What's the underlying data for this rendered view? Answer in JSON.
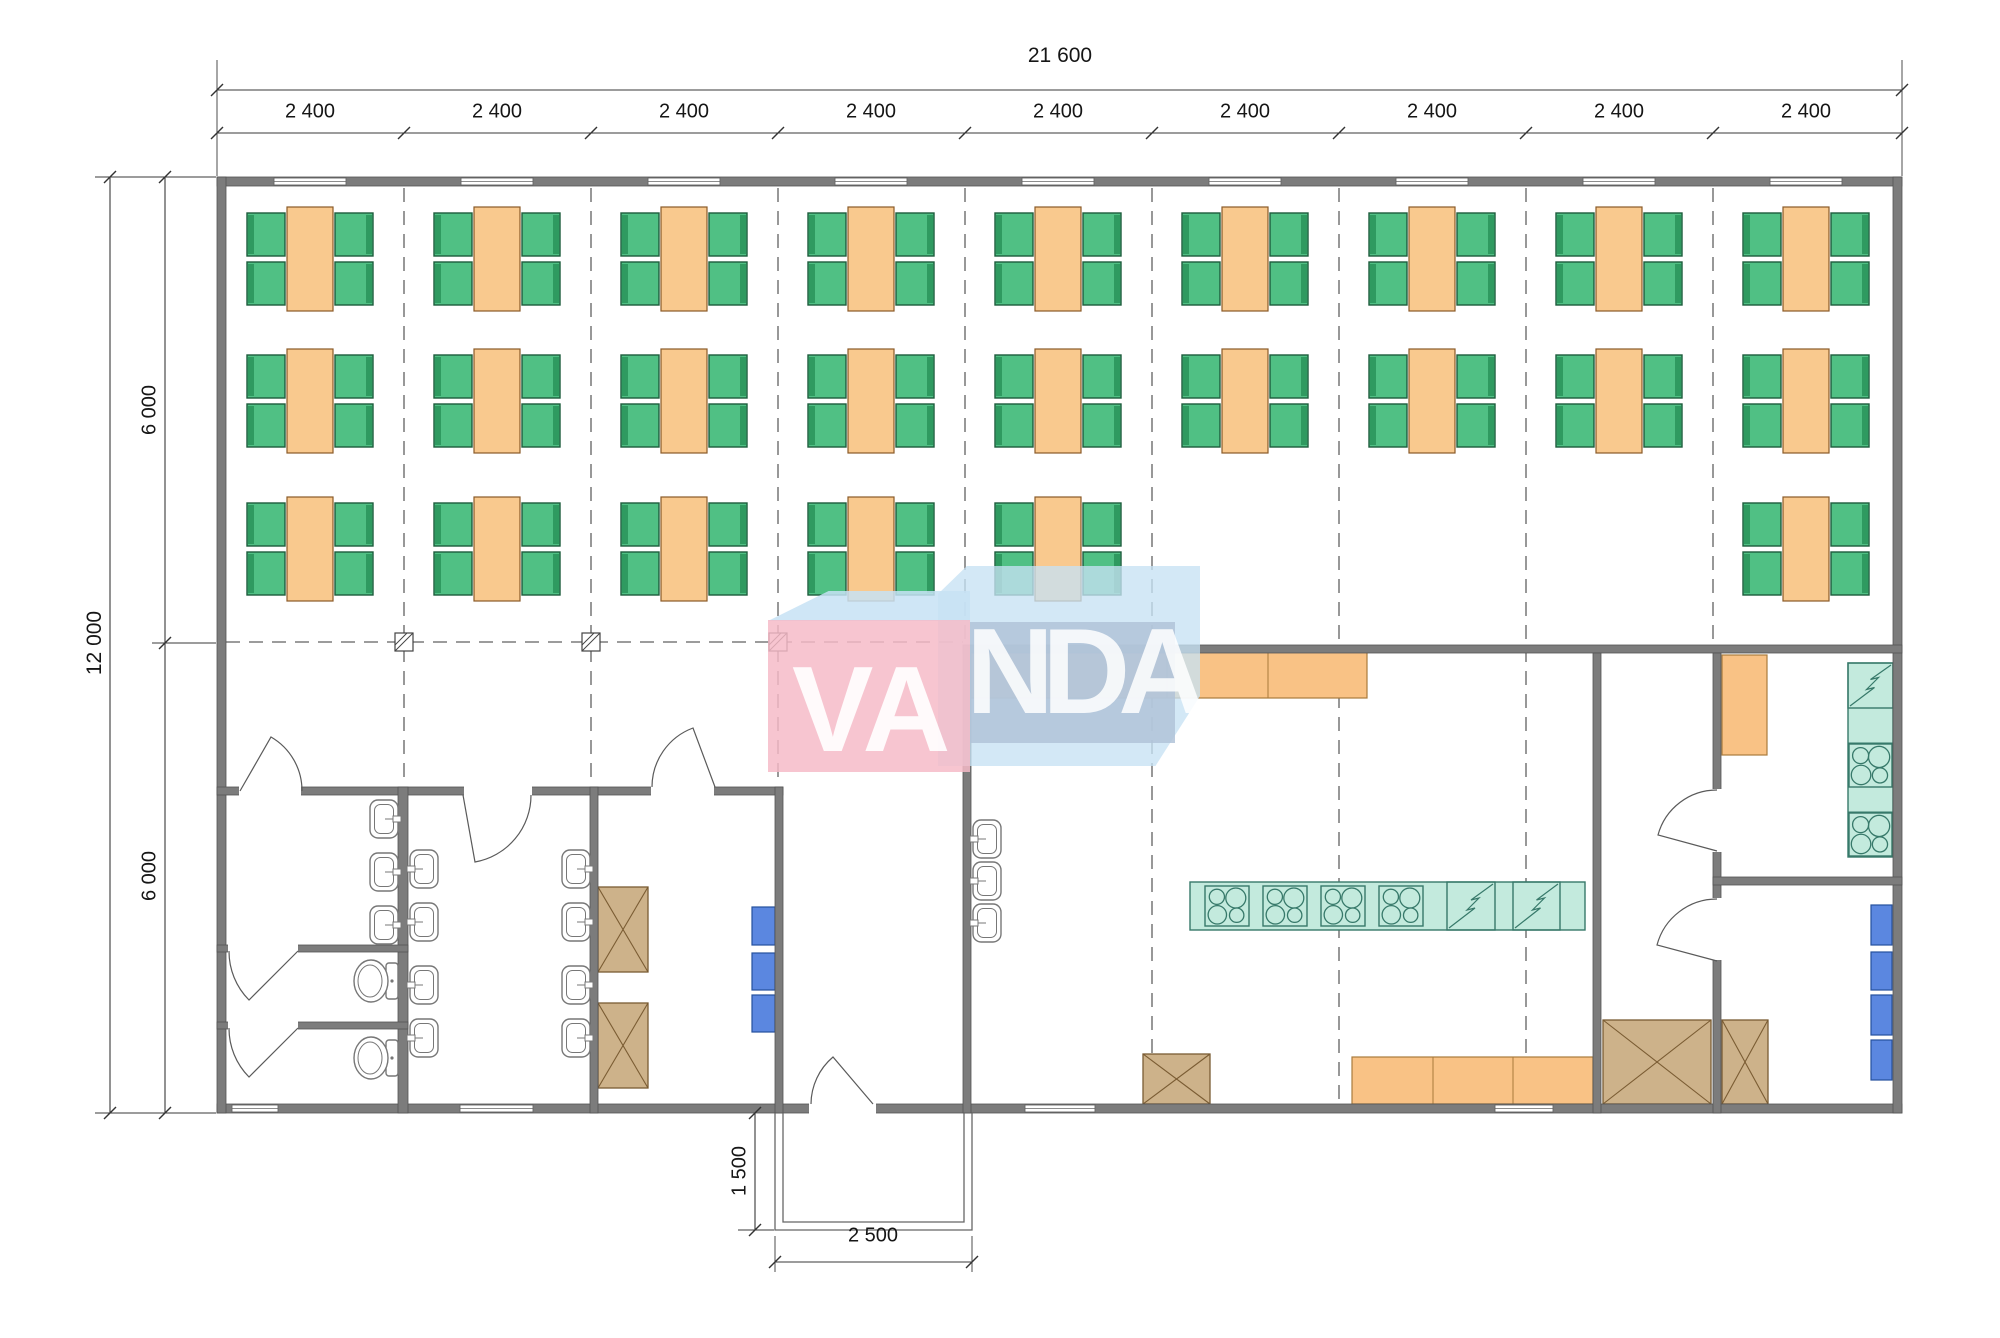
{
  "watermark": {
    "left": "VA",
    "right": "NDA"
  },
  "dimensions": {
    "total_width": "21 600",
    "module_widths": [
      "2 400",
      "2 400",
      "2 400",
      "2 400",
      "2 400",
      "2 400",
      "2 400",
      "2 400",
      "2 400"
    ],
    "total_depth": "12 000",
    "depth_halves": [
      "6 000",
      "6 000"
    ],
    "entrance_porch_depth": "1 500",
    "entrance_porch_width": "2 500"
  },
  "colors": {
    "wall": "#7c7c7c",
    "wallEdge": "#545454",
    "table": "#f9c98e",
    "tableEdge": "#8a5a28",
    "chair": "#50c084",
    "chairDark": "#2f9a60",
    "chairEdge": "#1d5c3c",
    "counter": "#f9c285",
    "counterEdge": "#a97b3c",
    "teal": "#c3eadd",
    "tealEdge": "#37796a",
    "blue": "#5b87e0",
    "blueEdge": "#24509e",
    "cabinet": "#cdb28a",
    "cabinetEdge": "#7a5c33",
    "fixture": "#777777",
    "line": "#5a5a5a",
    "grid": "#606060",
    "dim": "#3a3a3a"
  },
  "plan": {
    "moduleCenters": [
      310,
      497,
      684,
      871,
      1058,
      1245,
      1432,
      1619,
      1806
    ],
    "tables": {
      "rows": [
        259,
        401,
        549
      ],
      "layout": [
        [
          1,
          1,
          1,
          1,
          1,
          1,
          1,
          1,
          1
        ],
        [
          1,
          1,
          1,
          1,
          1,
          1,
          1,
          1,
          1
        ],
        [
          1,
          1,
          1,
          1,
          1,
          0,
          0,
          0,
          1
        ]
      ]
    },
    "gridV": [
      [
        404,
        188,
        785
      ],
      [
        591,
        188,
        785
      ],
      [
        778,
        188,
        785
      ],
      [
        965,
        188,
        643
      ],
      [
        1152,
        188,
        1102
      ],
      [
        1339,
        188,
        1102
      ],
      [
        1526,
        188,
        1102
      ],
      [
        1713,
        188,
        650
      ]
    ],
    "gridH": [
      [
        226,
        642,
        963
      ]
    ],
    "markers": [
      [
        404,
        642
      ],
      [
        591,
        642
      ],
      [
        778,
        642
      ]
    ],
    "walls": [
      [
        217,
        177,
        1685,
        9
      ],
      [
        217,
        1104,
        1685,
        9
      ],
      [
        217,
        177,
        9,
        936
      ],
      [
        1893,
        177,
        9,
        936
      ],
      [
        217,
        787,
        566,
        8
      ],
      [
        398,
        787,
        10,
        326
      ],
      [
        217,
        945,
        191,
        7
      ],
      [
        217,
        1022,
        191,
        7
      ],
      [
        590,
        787,
        8,
        326
      ],
      [
        775,
        787,
        8,
        326
      ],
      [
        963,
        645,
        939,
        8
      ],
      [
        963,
        645,
        8,
        468
      ],
      [
        1593,
        653,
        8,
        460
      ],
      [
        1713,
        653,
        8,
        460
      ],
      [
        1713,
        877,
        189,
        8
      ]
    ],
    "windowsTop": {
      "y": 178,
      "w": 72,
      "h": 7
    },
    "windowsBottom": [
      [
        232,
        1105,
        46,
        7
      ],
      [
        460,
        1105,
        73,
        7
      ],
      [
        1025,
        1105,
        70,
        7
      ],
      [
        1495,
        1105,
        58,
        7
      ]
    ],
    "doorOpenings": [
      [
        239,
        785,
        62,
        11
      ],
      [
        464,
        785,
        68,
        11
      ],
      [
        651,
        785,
        63,
        11
      ],
      [
        809,
        1102,
        67,
        12
      ],
      [
        228,
        943,
        70,
        10
      ],
      [
        228,
        1020,
        70,
        10
      ],
      [
        1711,
        789,
        11,
        63
      ],
      [
        1711,
        898,
        11,
        62
      ]
    ],
    "doorArcs": [
      "M240,791 L271,737 A62,62 0 0 1 302,791",
      "M463,795 L475,862 A68,68 0 0 0 531,795",
      "M715,787 L693,728 A63,63 0 0 0 652,787",
      "M873,1104 L833,1057 A62,62 0 0 0 811,1104",
      "M298,951 L249,1000 A69,69 0 0 1 229,951",
      "M298,1028 L249,1077 A69,69 0 0 1 229,1028",
      "M1717,851 L1658,835 A61,61 0 0 1 1717,790",
      "M1717,961 L1657,945 A62,62 0 0 1 1717,899"
    ],
    "counters": [
      {
        "x": 971,
        "y": 652,
        "w": 396,
        "h": 46,
        "div": [
          1068,
          1167,
          1268
        ]
      },
      {
        "x": 1352,
        "y": 1057,
        "w": 241,
        "h": 47,
        "div": [
          1433,
          1513
        ]
      },
      {
        "x": 1722,
        "y": 655,
        "w": 45,
        "h": 100,
        "div": []
      }
    ],
    "island": {
      "x": 1190,
      "y": 882,
      "w": 395,
      "h": 48,
      "stoves": [
        [
          1205,
          886,
          44,
          40
        ],
        [
          1263,
          886,
          44,
          40
        ],
        [
          1321,
          886,
          44,
          40
        ],
        [
          1379,
          886,
          44,
          40
        ]
      ],
      "diag": [
        [
          1447,
          882,
          48,
          48
        ],
        [
          1513,
          882,
          47,
          48
        ]
      ]
    },
    "wallColumn": {
      "x": 1848,
      "y": 663,
      "w": 45,
      "h": 194,
      "div": [
        708,
        743,
        787,
        812
      ],
      "zig": [
        1848,
        663,
        45,
        45
      ],
      "stoves": [
        [
          1849,
          744,
          43,
          43
        ],
        [
          1849,
          813,
          43,
          43
        ]
      ]
    },
    "cabinets": [
      [
        598,
        887,
        50,
        85
      ],
      [
        598,
        1003,
        50,
        85
      ],
      [
        1143,
        1054,
        67,
        50
      ],
      [
        1603,
        1020,
        108,
        84
      ],
      [
        1722,
        1020,
        46,
        84
      ]
    ],
    "blueUnits": [
      [
        752,
        907,
        23,
        38
      ],
      [
        752,
        953,
        23,
        37
      ],
      [
        752,
        995,
        23,
        37
      ],
      [
        1871,
        905,
        21,
        40
      ],
      [
        1871,
        952,
        21,
        38
      ],
      [
        1871,
        995,
        21,
        40
      ],
      [
        1871,
        1040,
        21,
        40
      ]
    ],
    "sinks": [
      {
        "x": 370,
        "y": 800,
        "tap": "right"
      },
      {
        "x": 370,
        "y": 853,
        "tap": "right"
      },
      {
        "x": 370,
        "y": 906,
        "tap": "right"
      },
      {
        "x": 410,
        "y": 850,
        "tap": "left"
      },
      {
        "x": 410,
        "y": 903,
        "tap": "left"
      },
      {
        "x": 410,
        "y": 966,
        "tap": "left"
      },
      {
        "x": 410,
        "y": 1019,
        "tap": "left"
      },
      {
        "x": 562,
        "y": 850,
        "tap": "right"
      },
      {
        "x": 562,
        "y": 903,
        "tap": "right"
      },
      {
        "x": 562,
        "y": 966,
        "tap": "right"
      },
      {
        "x": 562,
        "y": 1019,
        "tap": "right"
      },
      {
        "x": 973,
        "y": 820,
        "tap": "left"
      },
      {
        "x": 973,
        "y": 862,
        "tap": "left"
      },
      {
        "x": 973,
        "y": 904,
        "tap": "left"
      }
    ],
    "toilets": [
      {
        "x": 386,
        "y": 963
      },
      {
        "x": 386,
        "y": 1040
      }
    ],
    "porch": [
      "M775,1113 L775,1230 L972,1230 L972,1113",
      "M783,1113 L783,1222 L964,1222 L964,1113"
    ],
    "dimLines": [
      [
        217,
        90,
        1902,
        90
      ],
      [
        217,
        133,
        1902,
        133
      ],
      [
        110,
        177,
        110,
        1113
      ],
      [
        165,
        177,
        165,
        1113
      ],
      [
        755,
        1113,
        755,
        1230
      ],
      [
        775,
        1262,
        972,
        1262
      ]
    ],
    "dimSlashes": [
      [
        217,
        90
      ],
      [
        1902,
        90
      ],
      [
        217,
        133
      ],
      [
        404,
        133
      ],
      [
        591,
        133
      ],
      [
        778,
        133
      ],
      [
        965,
        133
      ],
      [
        1152,
        133
      ],
      [
        1339,
        133
      ],
      [
        1526,
        133
      ],
      [
        1713,
        133
      ],
      [
        1902,
        133
      ],
      [
        110,
        177
      ],
      [
        110,
        1113
      ],
      [
        165,
        177
      ],
      [
        165,
        643
      ],
      [
        165,
        1113
      ],
      [
        755,
        1113
      ],
      [
        755,
        1230
      ],
      [
        775,
        1262
      ],
      [
        972,
        1262
      ]
    ],
    "extLines": [
      [
        217,
        60,
        217,
        176
      ],
      [
        1902,
        60,
        1902,
        176
      ],
      [
        95,
        177,
        216,
        177
      ],
      [
        95,
        1113,
        216,
        1113
      ],
      [
        152,
        643,
        216,
        643
      ],
      [
        738,
        1230,
        774,
        1230
      ],
      [
        775,
        1236,
        775,
        1272
      ],
      [
        972,
        1236,
        972,
        1272
      ]
    ],
    "labels": [
      {
        "bind": "dimensions.total_width",
        "x": 1060,
        "y": 56,
        "big": true
      },
      {
        "bind": "dimensions.module_widths.0",
        "x": 310,
        "y": 112
      },
      {
        "bind": "dimensions.module_widths.1",
        "x": 497,
        "y": 112
      },
      {
        "bind": "dimensions.module_widths.2",
        "x": 684,
        "y": 112
      },
      {
        "bind": "dimensions.module_widths.3",
        "x": 871,
        "y": 112
      },
      {
        "bind": "dimensions.module_widths.4",
        "x": 1058,
        "y": 112
      },
      {
        "bind": "dimensions.module_widths.5",
        "x": 1245,
        "y": 112
      },
      {
        "bind": "dimensions.module_widths.6",
        "x": 1432,
        "y": 112
      },
      {
        "bind": "dimensions.module_widths.7",
        "x": 1619,
        "y": 112
      },
      {
        "bind": "dimensions.module_widths.8",
        "x": 1806,
        "y": 112
      },
      {
        "bind": "dimensions.total_depth",
        "x": 95,
        "y": 643,
        "rot": true,
        "big": true
      },
      {
        "bind": "dimensions.depth_halves.0",
        "x": 150,
        "y": 410,
        "rot": true
      },
      {
        "bind": "dimensions.depth_halves.1",
        "x": 150,
        "y": 876,
        "rot": true
      },
      {
        "bind": "dimensions.entrance_porch_depth",
        "x": 740,
        "y": 1171,
        "rot": true
      },
      {
        "bind": "dimensions.entrance_porch_width",
        "x": 873,
        "y": 1236
      }
    ]
  }
}
